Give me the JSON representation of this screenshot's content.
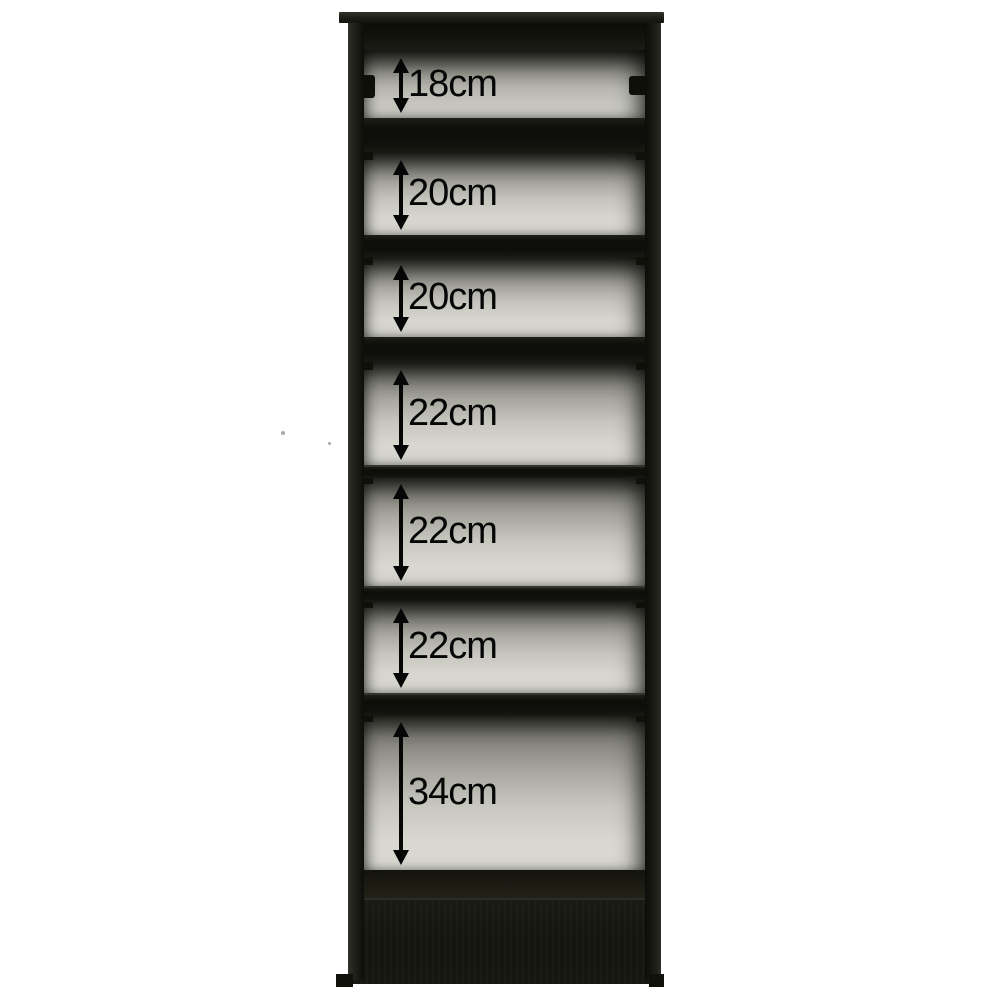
{
  "diagram": {
    "compartments": [
      {
        "label": "18cm"
      },
      {
        "label": "20cm"
      },
      {
        "label": "20cm"
      },
      {
        "label": "22cm"
      },
      {
        "label": "22cm"
      },
      {
        "label": "22cm"
      },
      {
        "label": "34cm"
      }
    ],
    "colors": {
      "background": "#ffffff",
      "frame": "#15150f",
      "back_panel_light": "#dcdcd4",
      "back_panel_shadow": "#5e5e56",
      "annotation": "#060606"
    }
  }
}
